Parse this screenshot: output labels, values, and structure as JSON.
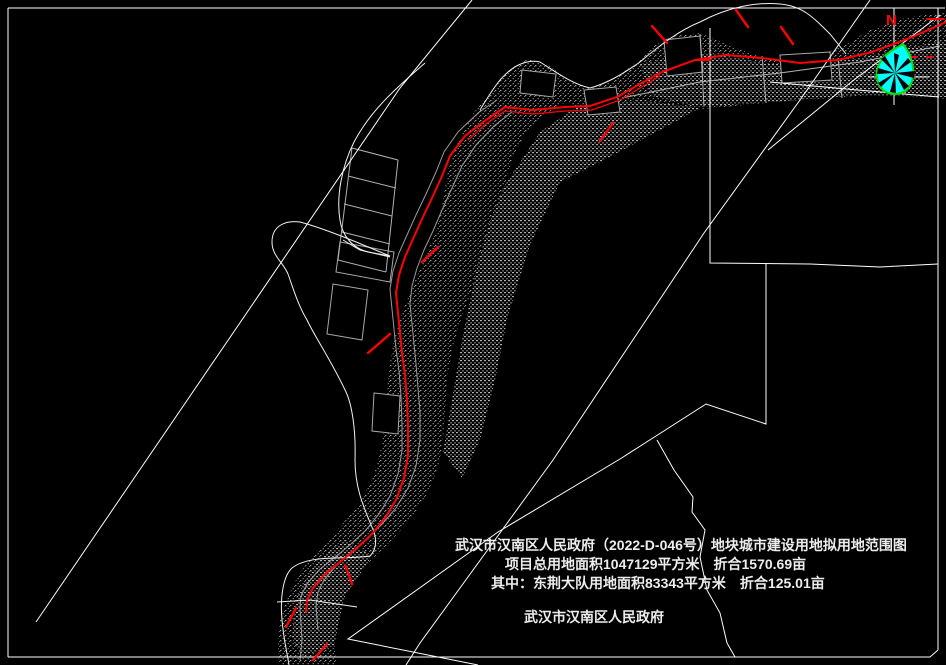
{
  "map": {
    "kind": "cadastral land-use boundary drawing",
    "annotations": {
      "title": "武汉市汉南区人民政府（2022-D-046号）地块城市建设用地拟用地范围图",
      "total_area_line": "项目总用地面积1047129平方米　折合1570.69亩",
      "subarea_line": "其中：东荆大队用地面积83343平方米　折合125.01亩",
      "issuer": "武汉市汉南区人民政府",
      "north_label": "N"
    },
    "figures": {
      "total_area_m2": "1047129",
      "total_area_mu": "1570.69",
      "dongjing_area_m2": "83343",
      "dongjing_area_mu": "125.01",
      "plot_number": "2022-D-046号"
    },
    "colors": {
      "background": "#000000",
      "boundary_white": "#ffffff",
      "terrain_gray": "#9a9a9a",
      "route_red": "#ff0000",
      "marker_fill_cyan": "#00ffff",
      "marker_outline_green": "#00e000"
    }
  }
}
